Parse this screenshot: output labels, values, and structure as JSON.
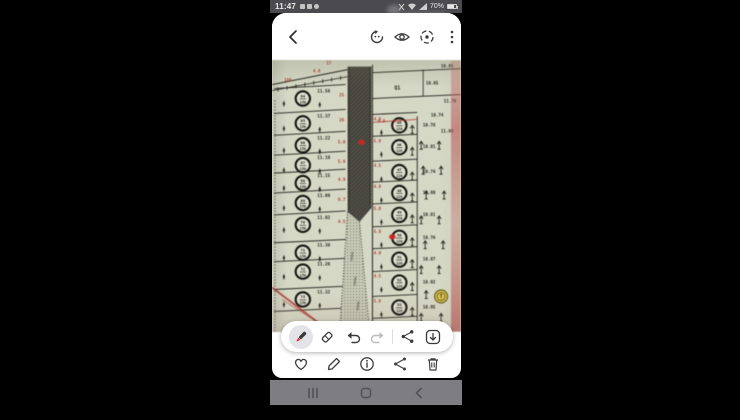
{
  "status_bar": {
    "time": "11:47",
    "battery_pct": "70%",
    "notification_icons": [
      "gallery-notif-icon",
      "message-notif-icon",
      "clock-notif-icon"
    ],
    "right_icons": [
      "vibrate-icon",
      "wifi-icon",
      "signal-icon",
      "battery-icon"
    ]
  },
  "app_toolbar": {
    "icons": [
      "back-icon",
      "rotate-icon",
      "eye-icon",
      "motion-photo-icon",
      "more-menu-icon"
    ]
  },
  "markup_toolbar": {
    "selected_tool": "pen",
    "pen_color": "#e02424",
    "tools": [
      "pen-tool",
      "eraser-tool",
      "undo",
      "redo",
      "share",
      "download"
    ]
  },
  "bottom_bar": {
    "actions": [
      "favorite",
      "edit",
      "details",
      "share",
      "delete"
    ]
  },
  "nav_bar": {
    "buttons": [
      "recents",
      "home",
      "back"
    ]
  },
  "map": {
    "bg_color": "#d9ddc7",
    "ink": "#23211a",
    "red": "#c03a30",
    "pen_red": "#e0231f",
    "stamp_color": "#e2c636",
    "left_rows": [
      {
        "y": 38,
        "id": "64",
        "area": "150",
        "dim": "11.56",
        "red": "25"
      },
      {
        "y": 63,
        "id": "65",
        "area": "150",
        "dim": "11.37",
        "red": "26"
      },
      {
        "y": 85,
        "id": "66",
        "area": "150",
        "dim": "11.22",
        "red": "5.0"
      },
      {
        "y": 105,
        "id": "67",
        "area": "150",
        "dim": "11.19",
        "red": "5.9"
      },
      {
        "y": 123,
        "id": "68",
        "area": "150",
        "dim": "11.15",
        "red": "4.9"
      },
      {
        "y": 143,
        "id": "69",
        "area": "150",
        "dim": "11.09",
        "red": "9.7"
      },
      {
        "y": 165,
        "id": "70",
        "area": "150",
        "dim": "11.02",
        "red": "4.5"
      },
      {
        "y": 193,
        "id": "71",
        "area": "150",
        "dim": "11.38",
        "red": "5.8"
      },
      {
        "y": 212,
        "id": "72",
        "area": "150",
        "dim": "11.26",
        "red": "16.1"
      },
      {
        "y": 240,
        "id": "73",
        "area": "150",
        "dim": "11.32",
        "red": "7.5"
      }
    ],
    "right_rows": [
      {
        "y": 65,
        "id": "45",
        "area": "120",
        "dim": "10.78",
        "red": "4.9"
      },
      {
        "y": 87,
        "id": "46",
        "area": "120",
        "dim": "10.81",
        "red": "5.9"
      },
      {
        "y": 112,
        "id": "47",
        "area": "120",
        "dim": "10.74",
        "red": "4.5"
      },
      {
        "y": 133,
        "id": "48",
        "area": "120",
        "dim": "10.80",
        "red": "4.8"
      },
      {
        "y": 155,
        "id": "49",
        "area": "120",
        "dim": "10.81",
        "red": "5.0"
      },
      {
        "y": 178,
        "id": "50",
        "area": "120",
        "dim": "10.76",
        "red": "5.9"
      },
      {
        "y": 200,
        "id": "51",
        "area": "120",
        "dim": "10.87",
        "red": "4.9"
      },
      {
        "y": 223,
        "id": "52",
        "area": "120",
        "dim": "10.92",
        "red": "4.5"
      },
      {
        "y": 248,
        "id": "53",
        "area": "120",
        "dim": "10.95",
        "red": "5.8"
      }
    ],
    "top_right": {
      "block_label": "Q1",
      "block_label_pos": [
        126,
        29
      ],
      "dims": [
        {
          "t": "10.85",
          "x": 176,
          "y": 7
        },
        {
          "t": "10.65",
          "x": 161,
          "y": 24
        },
        {
          "t": "11.78",
          "x": 179,
          "y": 42
        },
        {
          "t": "10.74",
          "x": 166,
          "y": 56
        },
        {
          "t": "11.80",
          "x": 176,
          "y": 72
        }
      ],
      "reds": [
        {
          "t": "4.9",
          "x": 110,
          "y": 62
        },
        {
          "t": "9.7",
          "x": 126,
          "y": 62
        }
      ]
    },
    "top_left_reds": [
      {
        "t": "186",
        "x": 16,
        "y": 21
      },
      {
        "t": "17",
        "x": 57,
        "y": 4
      },
      {
        "t": "4.6",
        "x": 45,
        "y": 12
      }
    ],
    "t_symbols": [
      [
        150,
        85
      ],
      [
        168,
        85
      ],
      [
        152,
        110
      ],
      [
        170,
        110
      ],
      [
        155,
        135
      ],
      [
        173,
        135
      ],
      [
        150,
        160
      ],
      [
        168,
        160
      ],
      [
        154,
        185
      ],
      [
        172,
        185
      ],
      [
        150,
        210
      ],
      [
        168,
        210
      ],
      [
        155,
        235
      ],
      [
        150,
        258
      ],
      [
        170,
        258
      ]
    ],
    "red_dots": [
      [
        90,
        82
      ],
      [
        121,
        177
      ]
    ],
    "stamp": {
      "x": 170,
      "y": 237,
      "label": "T"
    }
  }
}
